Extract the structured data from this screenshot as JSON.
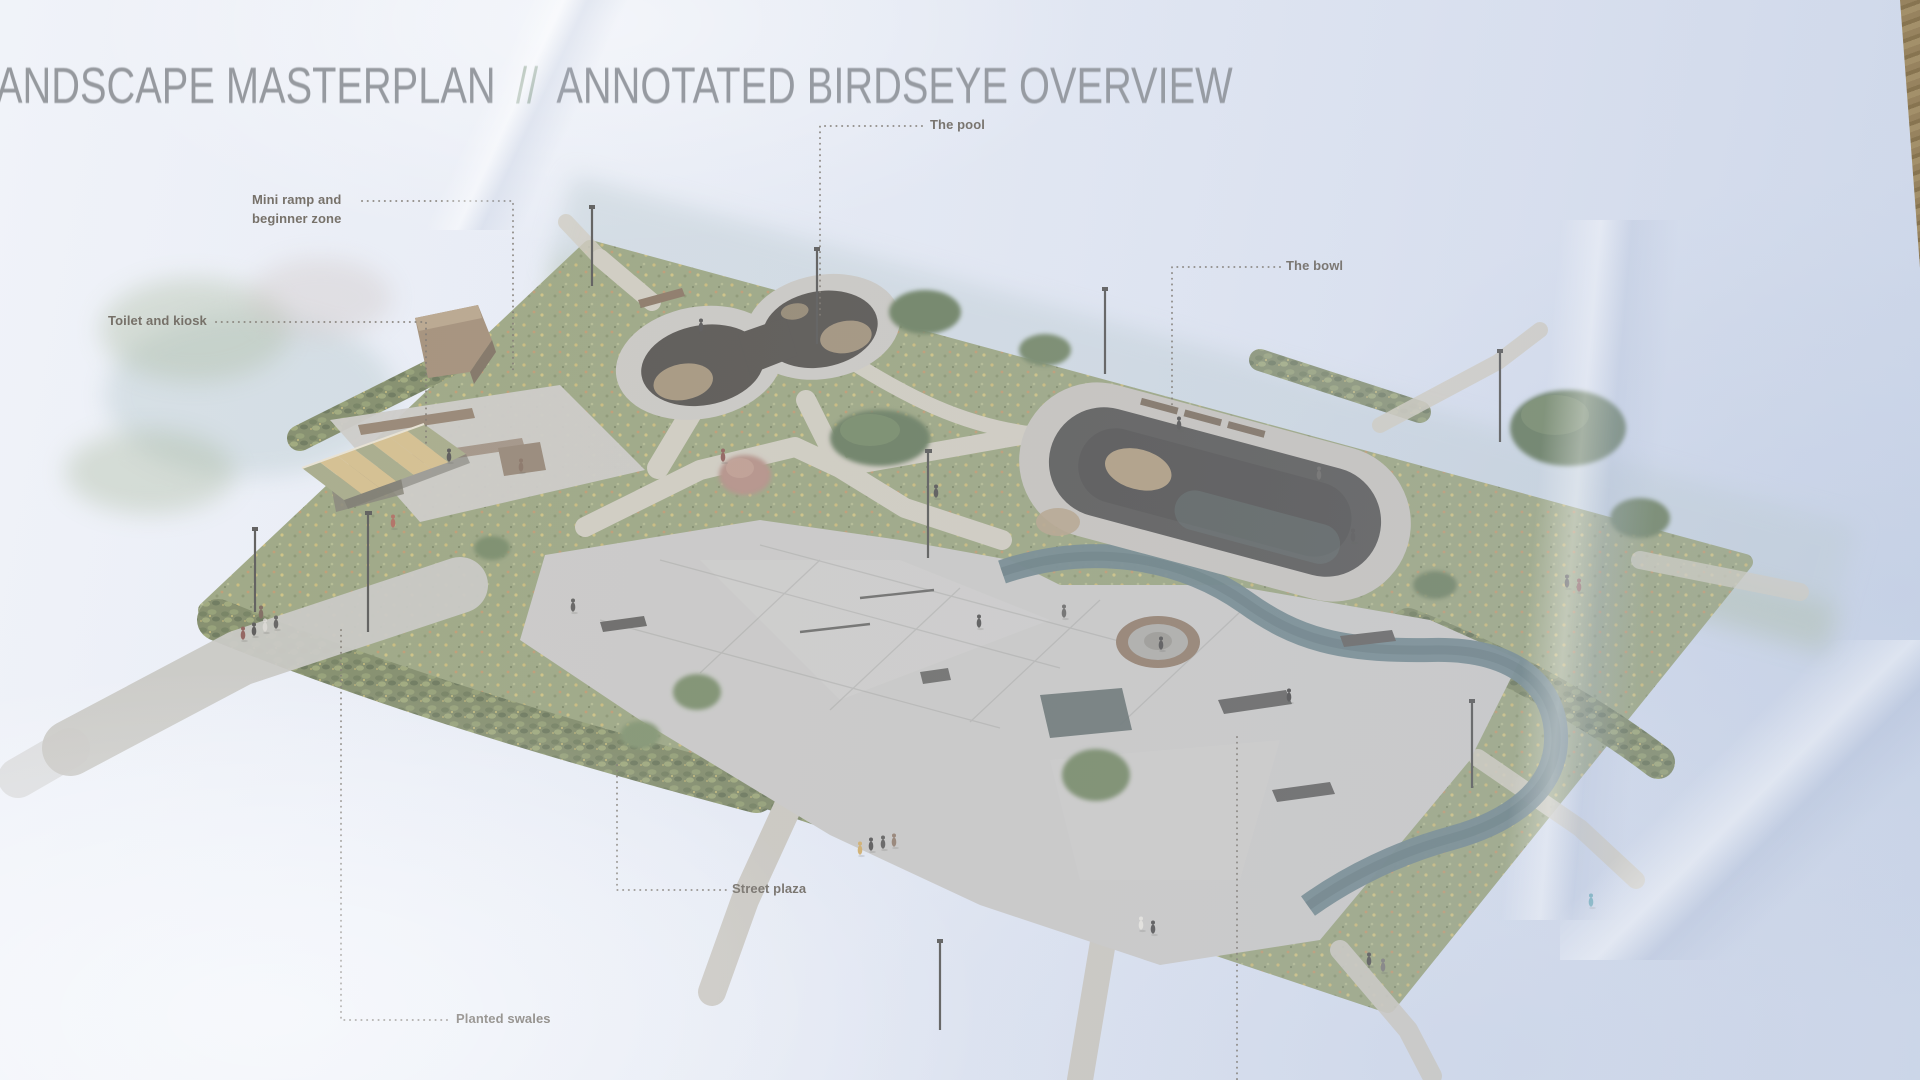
{
  "header": {
    "title_main": "ANDSCAPE MASTERPLAN",
    "title_separator": "//",
    "title_sub": "ANNOTATED BIRDSEYE OVERVIEW"
  },
  "annotations": {
    "pool": {
      "label": "The pool"
    },
    "mini_ramp": {
      "line1": "Mini ramp and",
      "line2": "beginner zone"
    },
    "toilet": {
      "label": "Toilet and kiosk"
    },
    "bowl": {
      "label": "The bowl"
    },
    "street_plaza": {
      "label": "Street plaza"
    },
    "swales": {
      "label": "Planted swales"
    }
  },
  "colors": {
    "paper": "#e3e8f3",
    "title_text": "#84888e",
    "title_slash": "#8da392",
    "label_text": "#5f584e",
    "leader_dots": "#6e675d",
    "meadow_green": "#8c9a63",
    "path_tan": "#cfc8b5",
    "plaza_gray": "#c6c4bf",
    "pool_dark": "#3b352e",
    "bowl_dark": "#403e3a",
    "ribbon_teal": "#57777d",
    "canopy_tan": "#d9b66b",
    "canopy_olive": "#9aa06b",
    "shrub_green": "#6b7a45",
    "table_edge_tan": "#97835f"
  }
}
